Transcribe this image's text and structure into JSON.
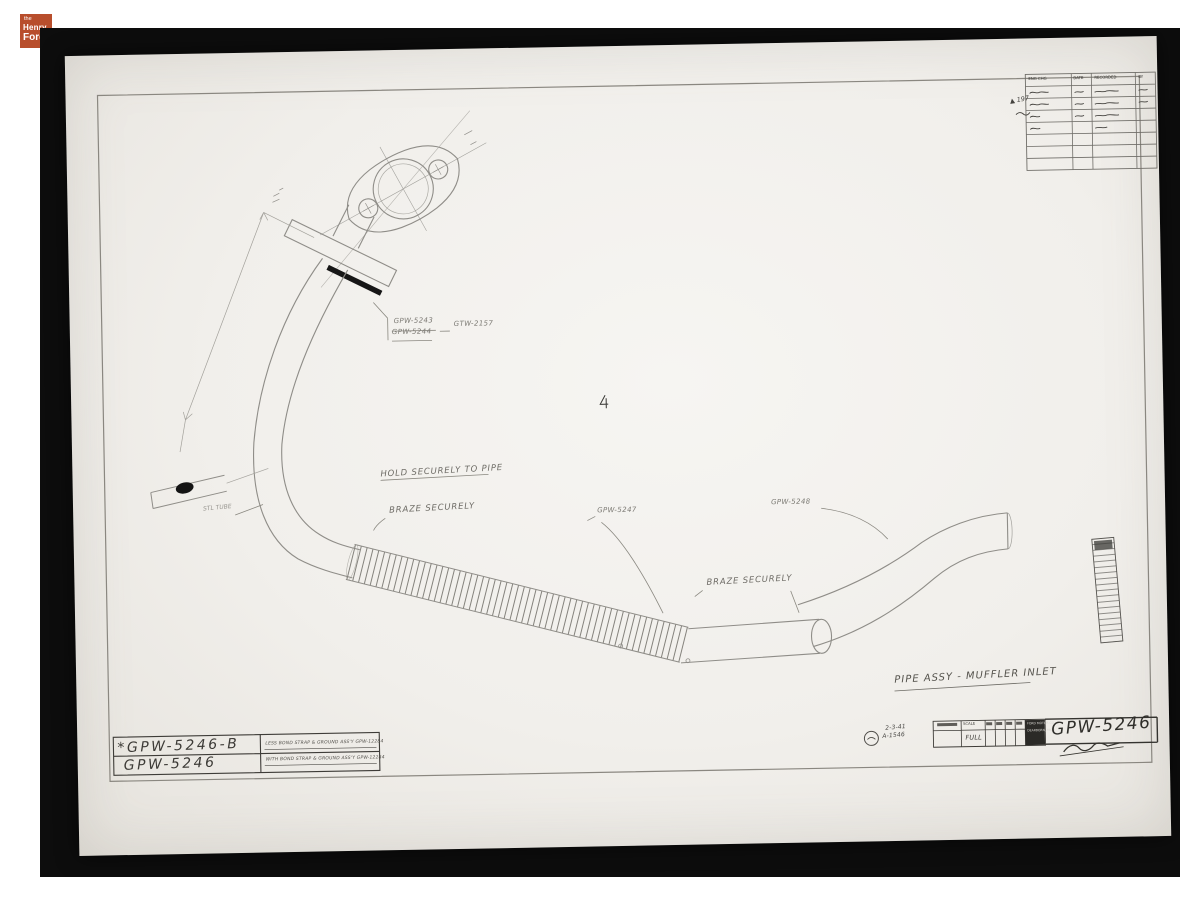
{
  "logo": {
    "line1": "the",
    "line2": "Henry",
    "line3": "Ford"
  },
  "drawing": {
    "callouts": {
      "part_upper_1": "GPW-5243",
      "part_upper_2": "GPW-5244",
      "part_upper_ref": "GTW-2157",
      "hold_note": "HOLD SECURELY TO PIPE",
      "braze_note_1": "BRAZE SECURELY",
      "part_mid": "GPW-5247",
      "part_right": "GPW-5248",
      "braze_note_2": "BRAZE SECURELY",
      "tube_note": "STL TUBE",
      "title": "PIPE ASSY - MUFFLER INLET"
    },
    "title_block": {
      "part_no_alt": "*GPW-5246-B",
      "part_no": "GPW-5246",
      "note_alt": "LESS BOND STRAP & GROUND ASS'Y GPW-12284",
      "note": "WITH BOND STRAP & GROUND ASS'Y GPW-12284"
    },
    "approval_block": {
      "date": "2-3-41",
      "ref": "A-1546",
      "scale_label": "SCALE",
      "scale_value": "FULL",
      "company_line1": "FORD MOTOR CO.",
      "company_line2": "DEARBORN, MICH.",
      "drawing_no": "GPW-5246"
    },
    "revision_table": {
      "headers": [
        "ENG CHG",
        "DATE",
        "RECORDED",
        "BY"
      ],
      "marker": "▲ 197"
    }
  }
}
